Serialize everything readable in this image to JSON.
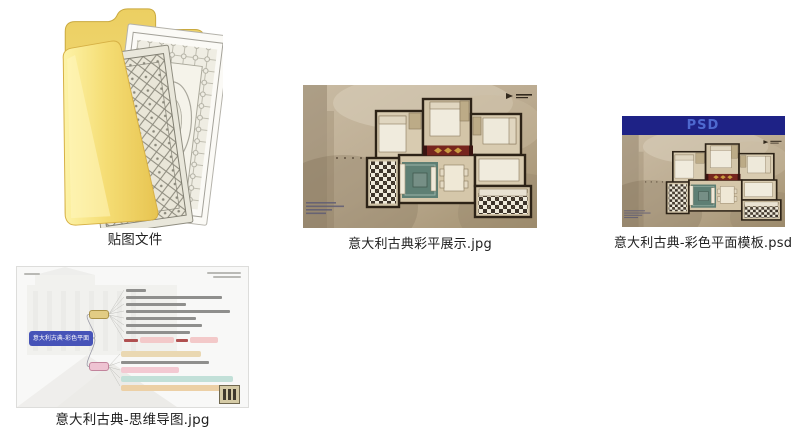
{
  "desktop": {
    "background": "#ffffff"
  },
  "files": [
    {
      "label": "贴图文件",
      "type": "folder",
      "icon": "folder-with-texture-previews"
    },
    {
      "label": "意大利古典彩平展示.jpg",
      "type": "jpg-image",
      "icon": "floorplan-thumbnail"
    },
    {
      "label": "意大利古典-彩色平面模板.psd",
      "type": "psd-file",
      "icon": "floorplan-thumbnail",
      "badge": "PSD"
    },
    {
      "label": "意大利古典-思维导图.jpg",
      "type": "jpg-image",
      "icon": "mindmap-thumbnail"
    }
  ],
  "psd_badge": {
    "text": "PSD",
    "background": "#1e2286",
    "color": "#4e69cf"
  },
  "mindmap": {
    "root_label": "意大利古典-彩色平面",
    "colors": {
      "root_node": "#4653b8",
      "branch_yellow": "#e2cc84",
      "branch_pink": "#eec3d2",
      "highlight_teal": "#c2e0d8",
      "highlight_pink": "#f3c9d2",
      "highlight_tan": "#ead8b2",
      "warning_red": "#b05050"
    }
  },
  "floorplan_colors": {
    "background_sepia": "#bdae96",
    "walls": "#2d2317",
    "rug_teal": "#5e7f74",
    "runner_red": "#76251e"
  }
}
